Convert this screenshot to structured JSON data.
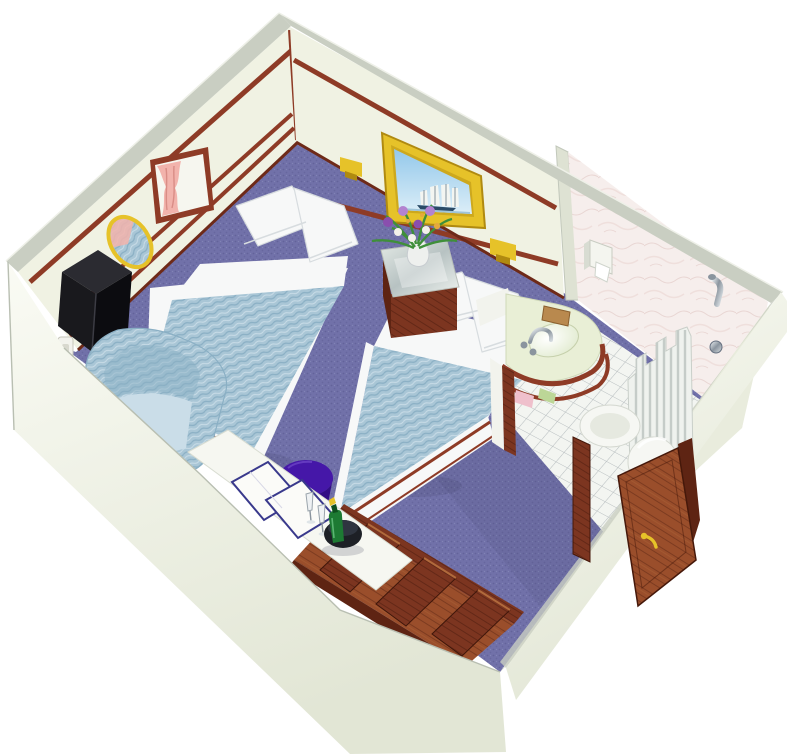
{
  "scene": {
    "type": "3d-cutaway-floorplan",
    "subject": "Cruise ship twin-bed cabin with en-suite bathroom, viewed isometrically from above with front walls cut away"
  },
  "colors": {
    "white": "#ffffff",
    "wallFace": "#f0f2e3",
    "wallTopEdge": "#c9cec2",
    "topHighlight": "#eef0e8",
    "wallInnerRight": "#e9ecdd",
    "wallBandFront": "#dee2d3",
    "wallOuterLight": "#fafbf4",
    "wallOuterShade": "#e2e6d5",
    "grayEdge": "#b9bfb2",
    "trim": "#8e3b26",
    "trimDark": "#6e2a18",
    "carpet": "#7171a9",
    "carpetDark": "#5d5d94",
    "carpetShadow": "#4a4a72",
    "tile": "#f3f5f1",
    "tileLine": "#b8bec0",
    "marble": "#f6eeec",
    "marbleVein": "#e9d6d3",
    "marbleVein2": "#efdfdc",
    "duvet": "#a9c6d6",
    "duvetDark": "#8aafc4",
    "duvetLight": "#cadde8",
    "linen": "#f7f8f8",
    "linenShade": "#d7dcdf",
    "woodDark": "#5e2413",
    "wood": "#7c3520",
    "woodBright": "#9a4e2b",
    "woodGrain": "#45180a",
    "woodHighlight": "#b06a3c",
    "gold": "#e6c229",
    "goldDark": "#b08a10",
    "skyTop": "#93c8ea",
    "skyBottom": "#dceef8",
    "shipHull": "#2a4a66",
    "sail": "#f3f5f1",
    "curtainPink": "#f2b3ac",
    "curtainPinkDark": "#d98d86",
    "windowWhite": "#f6f6ef",
    "mirrorGlass": "#87aec8",
    "tvTop": "#2b2b31",
    "tvLeft": "#19191d",
    "tvRight": "#0c0c10",
    "switchFace": "#f2f2ec",
    "switchInner": "#d8d8ce",
    "counter": "#e9efd6",
    "backsplash": "#f2f3ed",
    "basinA": "#ffffff",
    "basinB": "#dde8c8",
    "chromeA": "#f0f4f6",
    "chromeB": "#8a949e",
    "chromeC": "#d8dee2",
    "tan": "#b9894e",
    "dispenser": "#f4f5ef",
    "dispenserSide": "#d8dcd2",
    "curtainWhite": "#eff2ee",
    "curtainStripe": "#c5ccc8",
    "toilet": "#f6f7f3",
    "toiletShade": "#e6e9e0",
    "glassA": "#e4eae6",
    "glassB": "#b7c2c2",
    "glassC": "#f0f4f0",
    "stool": "#4517a8",
    "stoolDark": "#320d85",
    "bottle": "#1d7a33",
    "bottleDark": "#0e4f1e",
    "bucket": "#1d2026",
    "bucketRim": "#2f3540",
    "towelPink": "#efc0cc",
    "towelGreen": "#bcd697",
    "trayFill": "#fbfbf8",
    "navyTray": "#39398c",
    "deskTop": "#f6f7f1",
    "leaf": "#3f8f3a",
    "petalPurple": "#8a4fae",
    "petalLilac": "#b383d0",
    "petalWhite": "#f3f1ea",
    "petalGold": "#e4a93c",
    "vase": "#eef0ee",
    "shadow": "#32324e"
  },
  "inventory": [
    {
      "name": "bed-1",
      "description": "Twin bed, blue patterned duvet, white pillows"
    },
    {
      "name": "bed-2",
      "description": "Twin bed, blue patterned duvet, white pillows"
    },
    {
      "name": "nightstand",
      "description": "Wood nightstand with glass top and flower vase"
    },
    {
      "name": "ship-painting",
      "description": "Gold framed painting of a tall sailing ship"
    },
    {
      "name": "window",
      "description": "Window with pink curtains"
    },
    {
      "name": "mirror",
      "description": "Oval gold framed mirror"
    },
    {
      "name": "tv-set",
      "description": "Black corner-mounted television"
    },
    {
      "name": "armchair",
      "description": "Blue upholstered armchair"
    },
    {
      "name": "desk",
      "description": "White vanity desk with trays and champagne flutes"
    },
    {
      "name": "stool",
      "description": "Round purple stool"
    },
    {
      "name": "ice-bucket",
      "description": "Black ice bucket with champagne bottle"
    },
    {
      "name": "closet",
      "description": "Open wooden closet with dividers"
    },
    {
      "name": "entry-door",
      "description": "Open wooden entry door with gold handle"
    },
    {
      "name": "bathroom",
      "description": "Marble walled bathroom with sink, toilet, shower"
    }
  ]
}
